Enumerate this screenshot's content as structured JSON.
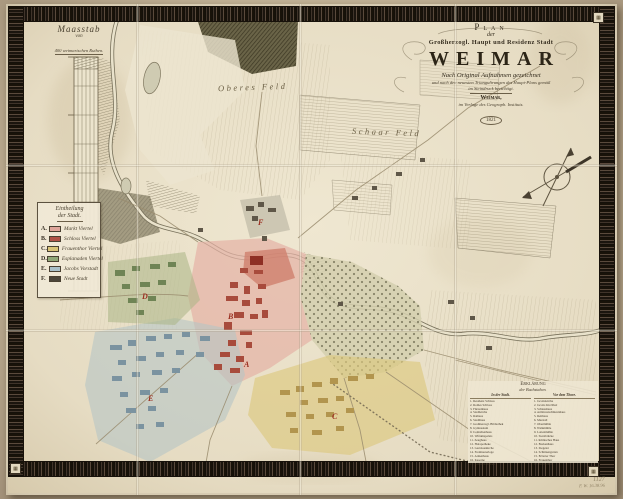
{
  "cartouche": {
    "plan": "Plan",
    "der": "der",
    "subtitle": "Großherzogl. Haupt und Residenz Stadt",
    "city": "WEIMAR",
    "line1": "Nach Original Aufnahmen gezeichnet",
    "line2": "und nach den neuesten Triangulirungen des Haupt-Plans gemäß",
    "line3": "im Steindruck berichtigt.",
    "place": "Weimar,",
    "publisher": "im Verlage des Geograph. Instituts.",
    "year": "1821"
  },
  "scale_bar": {
    "title": "Maasstab",
    "connector": "von",
    "caption": "400 weimarischen Ruthen."
  },
  "district_legend": {
    "title1": "Eintheilung",
    "title2": "der Stadt.",
    "items": [
      {
        "key": "A.",
        "label": "Markt Viertel",
        "color": "#dfa69b"
      },
      {
        "key": "B.",
        "label": "Schloss Viertel",
        "color": "#b05247"
      },
      {
        "key": "C.",
        "label": "Frauenthor Viertel",
        "color": "#d8c377"
      },
      {
        "key": "D.",
        "label": "Esplanaden Viertel",
        "color": "#90a878"
      },
      {
        "key": "E.",
        "label": "Jacobs Vorstadt",
        "color": "#a9c0c9"
      },
      {
        "key": "F.",
        "label": "Neue Stadt",
        "color": "#4c463a"
      }
    ]
  },
  "field_labels": {
    "label1": "Oberes Feld",
    "label2": "Schaar Feld"
  },
  "map_letters": {
    "a": "A",
    "b": "B",
    "c": "C",
    "d": "D",
    "e": "E",
    "f": "F"
  },
  "reference_list": {
    "header1": "Erklärung",
    "header2": "der Buchstaben.",
    "col1_title": "In der Stadt.",
    "col2_title": "Vor dem Thore.",
    "col1": [
      "1. Residenz Schloss",
      "2. Rothes Schloss",
      "3. Fürstenhaus",
      "4. Stadtkirche",
      "5. Rathaus",
      "6. Stadthaus",
      "7. Großherzogl. Bibliothek",
      "8. Gymnasium",
      "9. Comödienhaus",
      "10. Wittumspalais",
      "11. Zeughaus",
      "12. Hofapotheke",
      "13. Garnisonkirche",
      "14. Freimaurerloge",
      "15. Armenhaus",
      "16. Kaserne",
      "17. Landschaftshaus"
    ],
    "col2": [
      "1. Jacobskirche",
      "2. Jacobs Kirchhof",
      "3. Schiesshaus",
      "4. Armbrustschützenhaus",
      "5. Reithaus",
      "6. Marstall",
      "7. Obermühle",
      "8. Walkmühle",
      "9. Lottenmühle",
      "10. Sternbrücke",
      "11. Römisches Haus",
      "12. Borkenhaus",
      "13. Ziegelei",
      "14. Schützengarten",
      "15. Erfurter Thor",
      "16. Frauenthor",
      "17. Jacobsthor"
    ]
  },
  "pencil_notes": {
    "note1": "1127",
    "note2": "F. W. 16.38.96"
  }
}
